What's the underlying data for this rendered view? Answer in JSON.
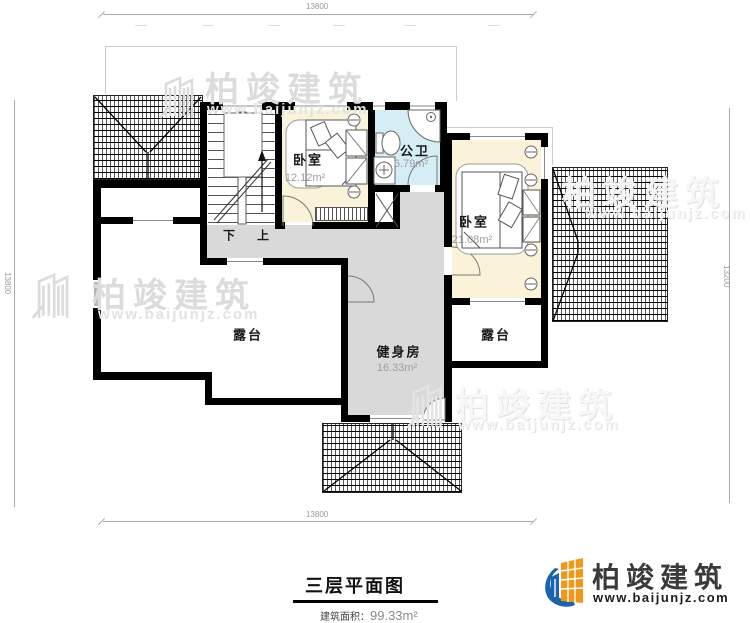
{
  "plan": {
    "rooms": {
      "bedroom1": {
        "name": "卧室",
        "area": "12.12m²"
      },
      "bathroom": {
        "name": "公卫",
        "area": "6.79m²"
      },
      "bedroom2": {
        "name": "卧室",
        "area": "21.08m²"
      },
      "gym": {
        "name": "健身房",
        "area": "16.33m²"
      },
      "terrace_left": {
        "name": "露台"
      },
      "terrace_right": {
        "name": "露台"
      },
      "stair_down": "下",
      "stair_up": "上"
    },
    "dimensions": {
      "top": "13800",
      "bottom": "13800",
      "left": "13800",
      "right": "13200"
    }
  },
  "watermark": {
    "brand": "柏竣建筑",
    "url": "www.baijunjz.com"
  },
  "titleblock": {
    "title": "三层平面图",
    "area_label": "建筑面积：",
    "area_value": "99.33m²"
  },
  "logo": {
    "brand": "柏竣建筑",
    "url": "www.baijunjz.com"
  },
  "colors": {
    "wall": "#000000",
    "bedroom_fill": "#faf3da",
    "bathroom_fill": "#d5eef6",
    "corridor_fill": "#d9d9d9",
    "watermark": "#dcdcdc",
    "logo_blue": "#1a63ad",
    "logo_orange": "#f0981b"
  }
}
